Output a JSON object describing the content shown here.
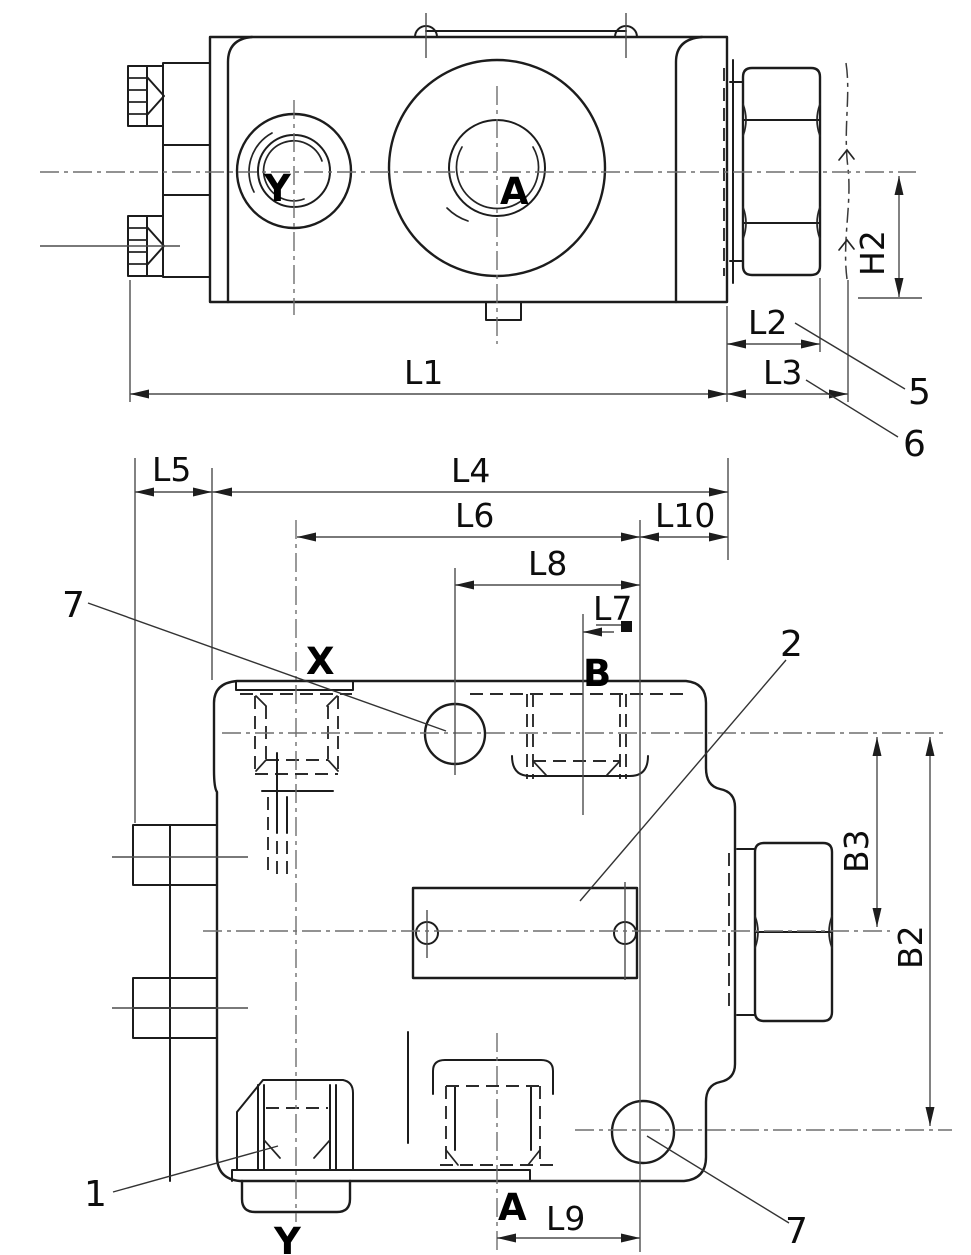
{
  "drawing": {
    "kind": "valve-dimensional-drawing",
    "background_color": "#ffffff",
    "line_color": "#1c1c1c",
    "dims": {
      "l1": "L1",
      "l2": "L2",
      "l3": "L3",
      "l4": "L4",
      "l5": "L5",
      "l6": "L6",
      "l7": "L7",
      "l8": "L8",
      "l9": "L9",
      "l10": "L10",
      "h2": "H2",
      "b2": "B2",
      "b3": "B3"
    },
    "ports": {
      "a": "A",
      "b": "B",
      "x": "X",
      "y": "Y"
    },
    "callouts": {
      "item1": "1",
      "item2": "2",
      "item5": "5",
      "item6": "6",
      "item7": "7"
    }
  }
}
